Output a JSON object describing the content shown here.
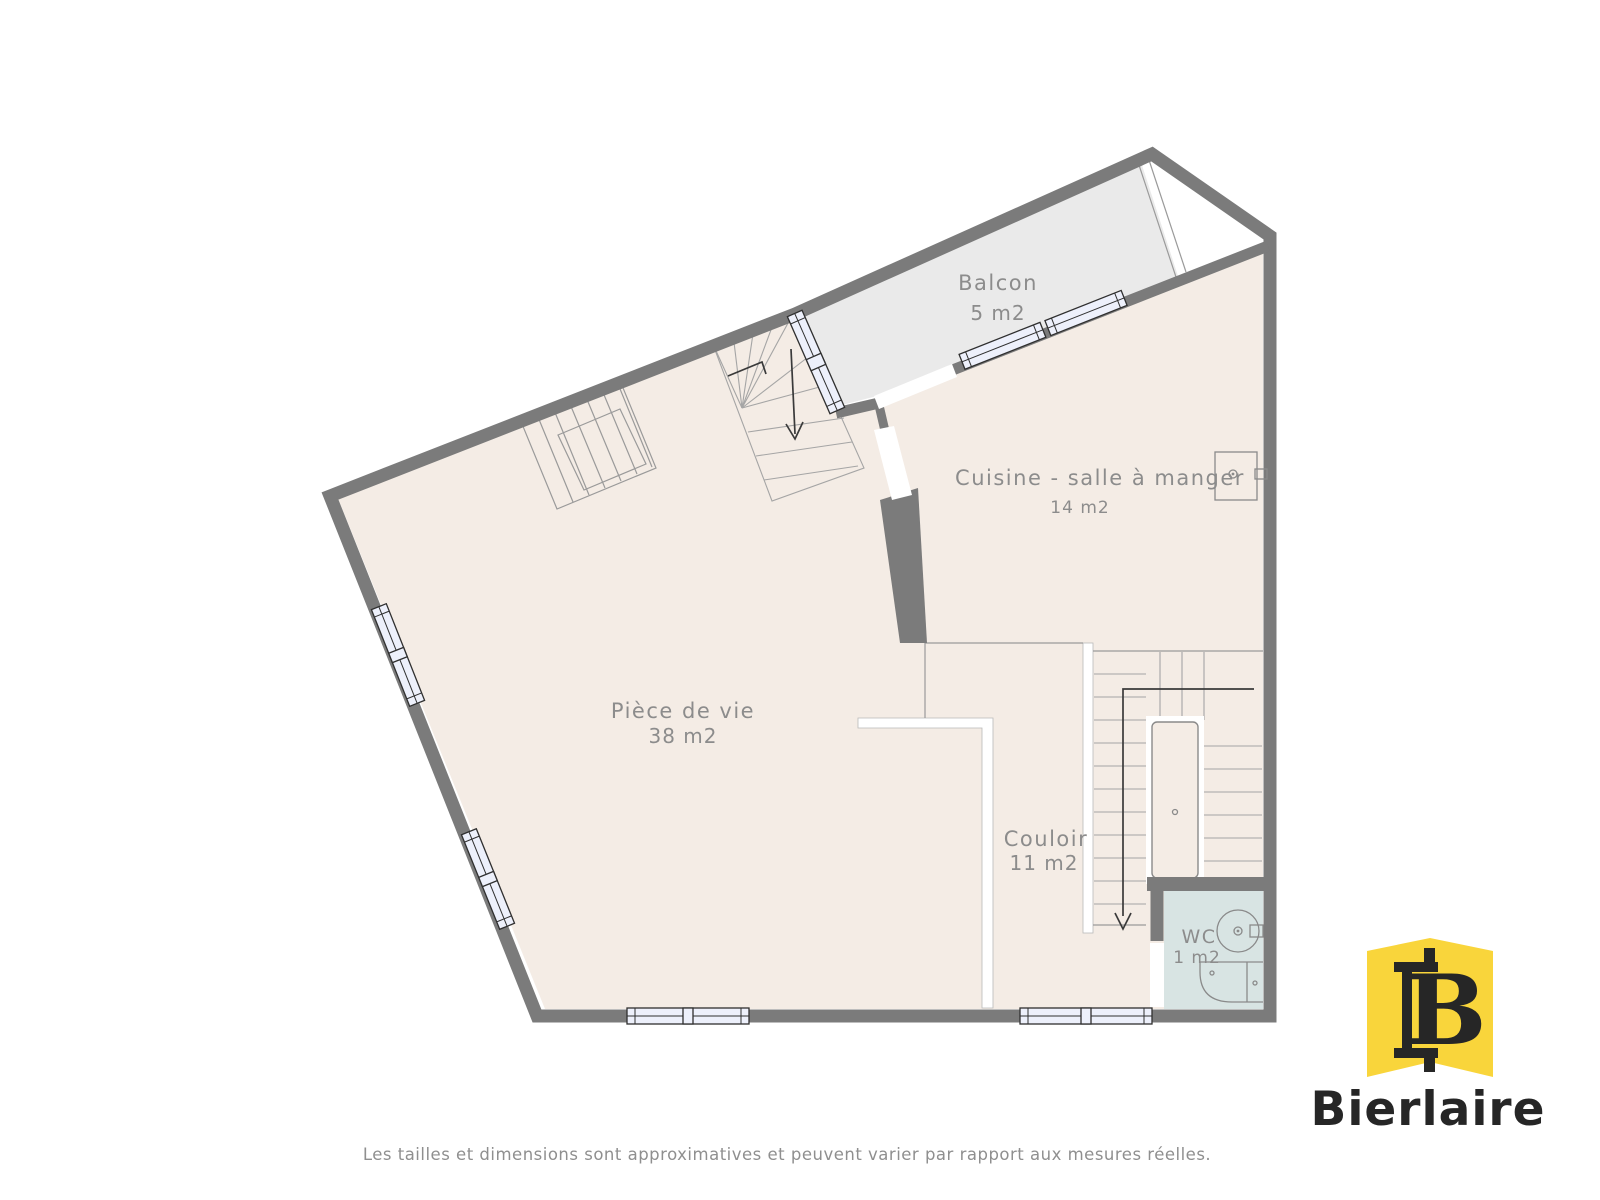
{
  "plan": {
    "rooms": [
      {
        "id": "balcon",
        "name": "Balcon",
        "area": "5 m2"
      },
      {
        "id": "cuisine",
        "name": "Cuisine - salle à manger",
        "area": "14 m2"
      },
      {
        "id": "piece-de-vie",
        "name": "Pièce de vie",
        "area": "38 m2"
      },
      {
        "id": "couloir",
        "name": "Couloir",
        "area": "11 m2"
      },
      {
        "id": "wc",
        "name": "WC",
        "area": "1 m2"
      }
    ],
    "colors": {
      "wall": "#7b7b7b",
      "floor": "#f4ece5",
      "balcony_floor": "#eaeaea",
      "wc_floor": "#d8e4e3",
      "window_fill": "#edf0fb",
      "label": "#8c8c8c"
    }
  },
  "branding": {
    "company": "Bierlaire",
    "logo_monogram": "B",
    "logo_color": "#f9d53b",
    "logo_text_color": "#262626"
  },
  "footer": {
    "disclaimer": "Les tailles et dimensions sont approximatives et peuvent varier par rapport aux mesures réelles."
  }
}
